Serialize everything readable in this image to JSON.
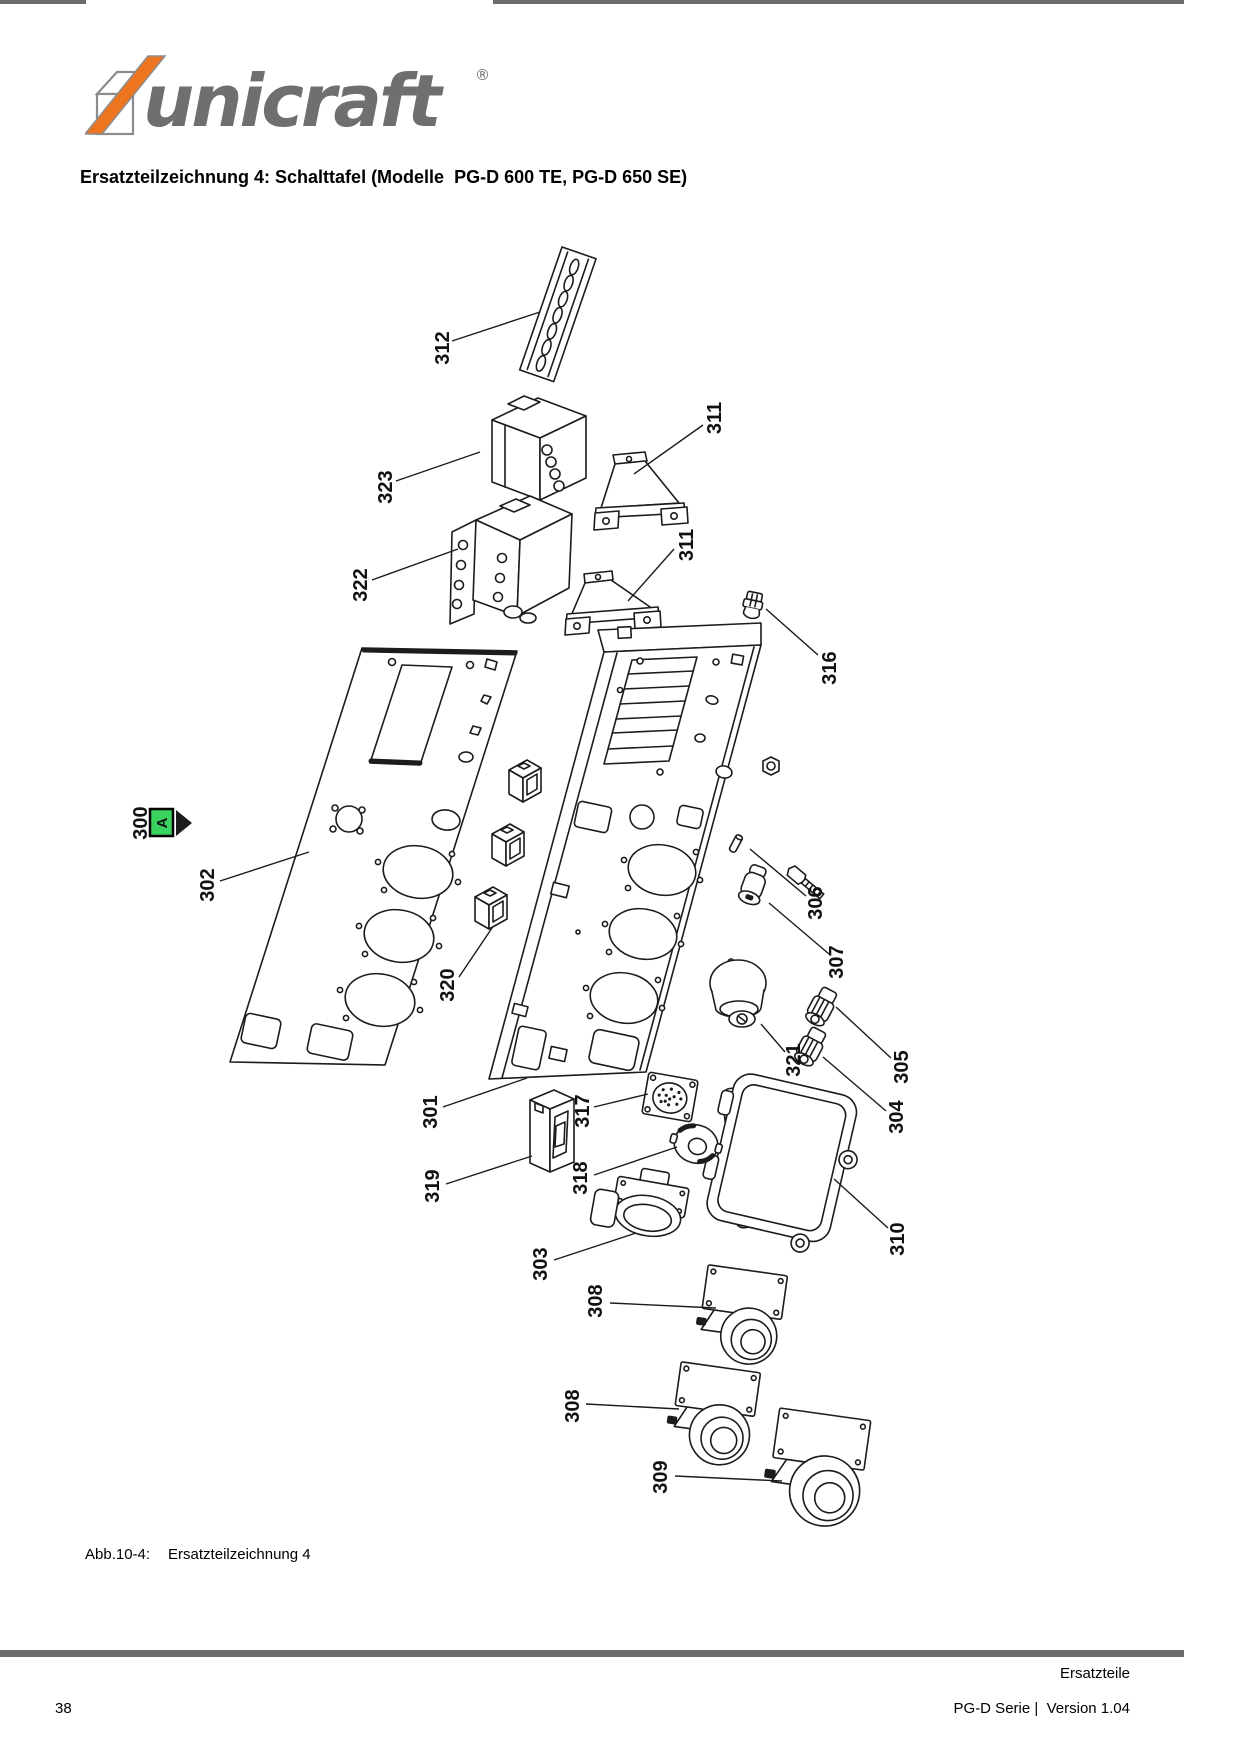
{
  "header": {
    "brand": "unicraft",
    "registered_mark": "®",
    "title": "Ersatzteilzeichnung 4: Schalttafel (Modelle  PG-D 600 TE, PG-D 650 SE)"
  },
  "figure": {
    "caption_label": "Abb.10-4:",
    "caption_text": "Ersatzteilzeichnung 4",
    "marker": {
      "part": "300",
      "letter": "A",
      "color": "#3bd35f"
    },
    "part_labels": [
      {
        "part": "312",
        "x": 442,
        "y": 348,
        "leader": [
          452,
          341,
          540,
          312
        ]
      },
      {
        "part": "323",
        "x": 385,
        "y": 487,
        "leader": [
          396,
          481,
          480,
          452
        ]
      },
      {
        "part": "311",
        "x": 714,
        "y": 418,
        "leader": [
          703,
          425,
          634,
          474
        ]
      },
      {
        "part": "322",
        "x": 360,
        "y": 585,
        "leader": [
          372,
          580,
          458,
          549
        ]
      },
      {
        "part": "311",
        "x": 686,
        "y": 545,
        "leader": [
          674,
          549,
          628,
          601
        ]
      },
      {
        "part": "316",
        "x": 829,
        "y": 668,
        "leader": [
          818,
          655,
          766,
          609
        ]
      },
      {
        "part": "302",
        "x": 207,
        "y": 885,
        "leader": [
          220,
          881,
          309,
          852
        ]
      },
      {
        "part": "320",
        "x": 447,
        "y": 985,
        "leader": [
          459,
          977,
          492,
          928
        ]
      },
      {
        "part": "306",
        "x": 815,
        "y": 903,
        "leader": [
          806,
          896,
          750,
          849
        ]
      },
      {
        "part": "307",
        "x": 836,
        "y": 962,
        "leader": [
          829,
          954,
          769,
          903
        ]
      },
      {
        "part": "321",
        "x": 793,
        "y": 1060,
        "leader": [
          785,
          1052,
          761,
          1024
        ]
      },
      {
        "part": "305",
        "x": 901,
        "y": 1067,
        "leader": [
          891,
          1058,
          836,
          1007
        ]
      },
      {
        "part": "304",
        "x": 896,
        "y": 1117,
        "leader": [
          886,
          1111,
          823,
          1057
        ]
      },
      {
        "part": "310",
        "x": 897,
        "y": 1239,
        "leader": [
          888,
          1228,
          834,
          1179
        ]
      },
      {
        "part": "301",
        "x": 430,
        "y": 1112,
        "leader": [
          443,
          1107,
          527,
          1078
        ]
      },
      {
        "part": "317",
        "x": 582,
        "y": 1111,
        "leader": [
          594,
          1107,
          648,
          1094
        ]
      },
      {
        "part": "319",
        "x": 432,
        "y": 1186,
        "leader": [
          446,
          1184,
          532,
          1156
        ]
      },
      {
        "part": "318",
        "x": 580,
        "y": 1178,
        "leader": [
          594,
          1175,
          677,
          1147
        ]
      },
      {
        "part": "303",
        "x": 540,
        "y": 1264,
        "leader": [
          554,
          1260,
          636,
          1233
        ]
      },
      {
        "part": "308",
        "x": 595,
        "y": 1301,
        "leader": [
          610,
          1303,
          716,
          1308
        ]
      },
      {
        "part": "308",
        "x": 572,
        "y": 1406,
        "leader": [
          586,
          1404,
          679,
          1409
        ]
      },
      {
        "part": "309",
        "x": 660,
        "y": 1477,
        "leader": [
          675,
          1476,
          782,
          1481
        ]
      }
    ]
  },
  "footer": {
    "section_label": "Ersatzteile",
    "page_number": "38",
    "version_text": "PG-D Serie |  Version 1.04"
  },
  "colors": {
    "logo_gray": "#6e6f71",
    "rule_gray": "#6a6b6d",
    "accent_orange": "#ee751f",
    "marker_green": "#3bd35f",
    "line_black": "#1c1c1c"
  }
}
